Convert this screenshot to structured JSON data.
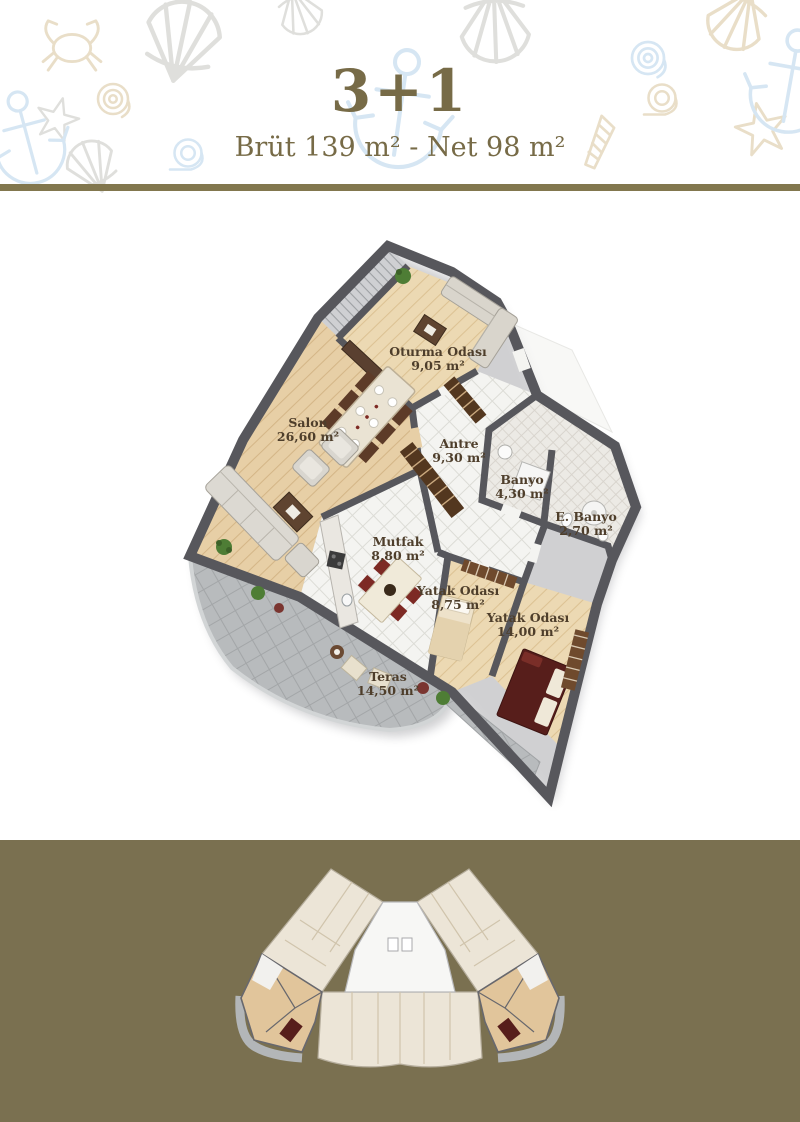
{
  "header": {
    "title": "3+1",
    "subtitle": "Brüt 139 m² - Net 98 m²"
  },
  "theme": {
    "accent": "#776b47",
    "divider_bar": "#82774e",
    "footer_background": "#7a7050",
    "wall": "#57575c",
    "wood_floor": "#e7cfa6",
    "white_tile": "#f4f4f1",
    "terrace_gray": "#b8bbbd",
    "bed_maroon": "#571e1b",
    "label_text": "#4e3e2b",
    "decor_beige": "#e5d9bf",
    "decor_blue": "#cfe2f1",
    "decor_gray": "#dadad6"
  },
  "decor": {
    "icons": [
      "crab-icon",
      "scallop-shell-icon",
      "spiral-shell-icon",
      "starfish-icon",
      "anchor-icon",
      "snail-shell-icon",
      "conch-shell-icon"
    ]
  },
  "plan": {
    "rooms": [
      {
        "name": "Oturma Odası",
        "area": "9,05 m²"
      },
      {
        "name": "Salon",
        "area": "26,60 m²"
      },
      {
        "name": "Antre",
        "area": "9,30 m²"
      },
      {
        "name": "Banyo",
        "area": "4,30 m²"
      },
      {
        "name": "E. Banyo",
        "area": "2,70 m²"
      },
      {
        "name": "Mutfak",
        "area": "8,80 m²"
      },
      {
        "name": "Yatak Odası",
        "area": "8,75 m²"
      },
      {
        "name": "Yatak Odası",
        "area": "14,00 m²"
      },
      {
        "name": "Teras",
        "area": "14,50 m²"
      }
    ]
  },
  "overview": {
    "description": "floor-plate key plan",
    "highlighted_units": 2
  }
}
